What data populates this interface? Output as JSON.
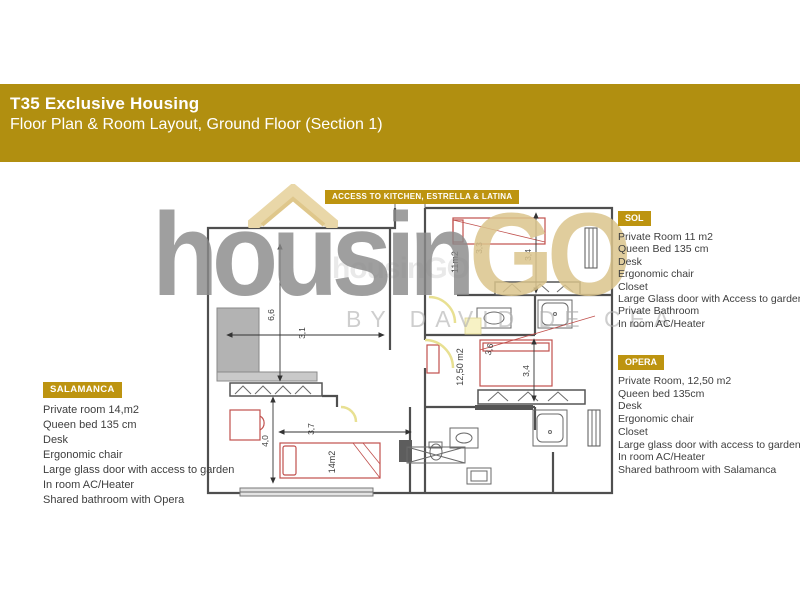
{
  "header": {
    "title": "T35 Exclusive Housing",
    "subtitle": "Floor Plan & Room Layout, Ground Floor (Section 1)"
  },
  "banner": {
    "label": "ACCESS TO KITCHEN, ESTRELLA & LATINA"
  },
  "watermark": {
    "word_main": "housin",
    "word_accent": "GO",
    "byline": "BY DAVID DE CEA",
    "mini": "housinGO"
  },
  "rooms": {
    "sol": {
      "name": "SOL",
      "features": [
        "Private Room  11 m2",
        "Queen Bed 135 cm",
        "Desk",
        "Ergonomic chair",
        "Closet",
        "Large Glass door with Access to garden",
        "Private Bathroom",
        "In room AC/Heater"
      ]
    },
    "opera": {
      "name": "OPERA",
      "features": [
        "Private Room, 12,50 m2",
        "Queen bed 135cm",
        "Desk",
        "Ergonomic chair",
        "Closet",
        "Large glass door with access to garden,",
        "In room AC/Heater",
        "Shared bathroom with Salamanca"
      ]
    },
    "salamanca": {
      "name": "SALAMANCA",
      "features": [
        "Private room 14,m2",
        "Queen bed 135 cm",
        "Desk",
        "Ergonomic chair",
        "Large glass door with access to garden",
        "In room AC/Heater",
        "Shared bathroom with Opera"
      ]
    }
  },
  "plan": {
    "dims": {
      "left_height": "6,6",
      "left_width": "3,1",
      "salamanca_height": "4,0",
      "salamanca_width": "3,7",
      "sol_width": "3,3",
      "sol_height": "3,4",
      "opera_width": "3,6",
      "opera_height": "3,4"
    },
    "areas": {
      "sol": "11m2",
      "opera": "12,50 m2",
      "salamanca": "14m2"
    }
  },
  "colors": {
    "band_gold": "#B18F10",
    "badge_gold": "#BD9410",
    "furniture_red": "#C0504D",
    "watermark_gray": "#8A8A8A",
    "watermark_tan": "#DBC48C"
  }
}
